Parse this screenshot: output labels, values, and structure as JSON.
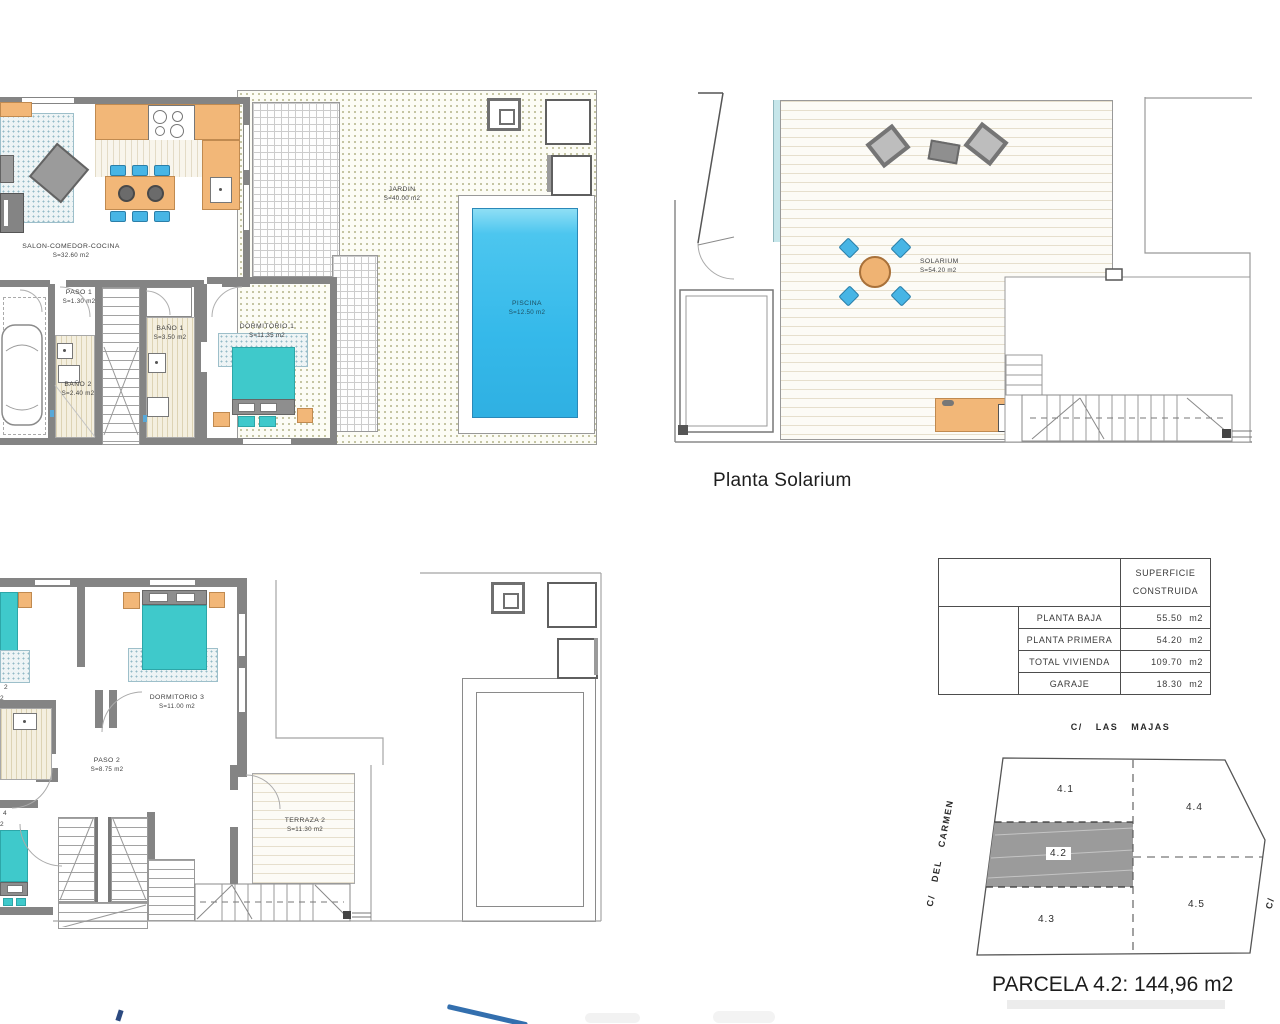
{
  "ground_floor": {
    "salon": {
      "name": "SALON-COMEDOR-COCINA",
      "area": "S=32.60 m2"
    },
    "paso1": {
      "name": "PASO 1",
      "area": "S=1.30 m2"
    },
    "bano1": {
      "name": "BAÑO 1",
      "area": "S=3.50 m2"
    },
    "bano2": {
      "name": "BAÑO 2",
      "area": "S=2.40 m2"
    },
    "dormitorio1": {
      "name": "DORMITORIO 1",
      "area": "S=11.35 m2"
    },
    "jardin": {
      "name": "JARDIN",
      "area": "S=40.00 m2"
    },
    "piscina": {
      "name": "PISCINA",
      "area": "S=12.50 m2"
    }
  },
  "solarium_floor": {
    "title": "Planta Solarium",
    "solarium": {
      "name": "SOLARIUM",
      "area": "S=54.20 m2"
    }
  },
  "first_floor": {
    "dormitorio3": {
      "name": "DORMITORIO 3",
      "area": "S=11.00 m2"
    },
    "paso2": {
      "name": "PASO 2",
      "area": "S=8.75 m2"
    },
    "terraza2": {
      "name": "TERRAZA 2",
      "area": "S=11.30 m2"
    },
    "cut_labels": {
      "top_a": "2",
      "top_b": "2",
      "bottom_a": "4",
      "bottom_b": "2"
    }
  },
  "surface_table": {
    "header_line1": "SUPERFICIE",
    "header_line2": "CONSTRUIDA",
    "rows": [
      {
        "label": "PLANTA BAJA",
        "value": "55.50 m2"
      },
      {
        "label": "PLANTA PRIMERA",
        "value": "54.20 m2"
      },
      {
        "label": "TOTAL VIVIENDA",
        "value": "109.70 m2"
      },
      {
        "label": "GARAJE",
        "value": "18.30 m2"
      }
    ]
  },
  "parcel_map": {
    "street_top": "C/ LAS MAJAS",
    "street_left": "C/ DEL CARMEN",
    "street_right": "C/",
    "parcels": {
      "p41": "4.1",
      "p42": "4.2",
      "p43": "4.3",
      "p44": "4.4",
      "p45": "4.5"
    },
    "caption": "PARCELA 4.2: 144,96 m2"
  },
  "colors": {
    "wall": "#848484",
    "furniture_orange": "#f2b778",
    "chair_blue": "#47b5e5",
    "bed_teal": "#3fc9cb",
    "pool_blue": "#3bbcec",
    "parcel_highlight": "#9b9b9b"
  }
}
